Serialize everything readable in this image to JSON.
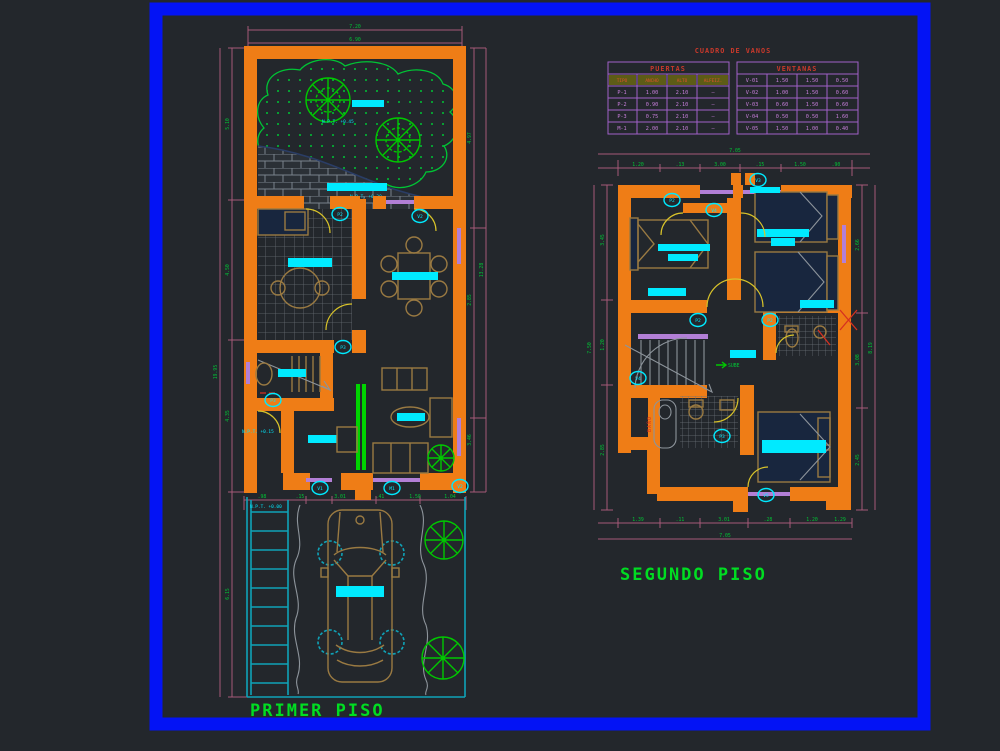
{
  "sheet": {
    "frame_color": "#0313f5",
    "background": "#23272c",
    "schedule_title": "CUADRO DE VANOS"
  },
  "floors": {
    "first": "PRIMER PISO",
    "second": "SEGUNDO PISO"
  },
  "tables": {
    "puertas": {
      "title": "PUERTAS",
      "headers": [
        "TIPO",
        "ANCHO",
        "ALTO",
        "ALFEIZ."
      ],
      "rows": [
        [
          "P-1",
          "1.00",
          "2.10",
          "—"
        ],
        [
          "P-2",
          "0.90",
          "2.10",
          "—"
        ],
        [
          "P-3",
          "0.75",
          "2.10",
          "—"
        ],
        [
          "M-1",
          "2.00",
          "2.10",
          "—"
        ]
      ]
    },
    "ventanas": {
      "title": "VENTANAS",
      "rows": [
        [
          "V-01",
          "1.50",
          "1.50",
          "0.50"
        ],
        [
          "V-02",
          "1.00",
          "1.50",
          "0.60"
        ],
        [
          "V-03",
          "0.60",
          "1.50",
          "0.60"
        ],
        [
          "V-04",
          "0.50",
          "0.50",
          "1.60"
        ],
        [
          "V-05",
          "1.50",
          "1.00",
          "0.40"
        ]
      ]
    }
  },
  "annotations": {
    "npt_garden": "N.P.T. +0.45",
    "npt_patio": "N.P.T. +0.30",
    "npt_hall": "N.P.T. +0.15",
    "npt_garage": "N.P.T. +0.00",
    "sube": "SUBE",
    "bano": "BAÑO"
  },
  "symbols": {
    "p1": "P1",
    "p2": "P2",
    "p3": "P3",
    "m1": "M1",
    "v1": "V1",
    "v2": "V2",
    "v3": "V3",
    "v4": "V4",
    "v5": "V5"
  },
  "dims": {
    "ff_top": [
      "7.20",
      "6.90"
    ],
    "ff_left": [
      "5.10",
      "4.50",
      "4.35",
      "6.15"
    ],
    "ff_left_total": "19.95",
    "ff_right": [
      "4.97",
      "2.85",
      "3.46"
    ],
    "ff_right_total": "13.28",
    "ff_bottom": [
      ".98",
      ".15",
      "3.01",
      ".41",
      "1.50",
      "1.04"
    ],
    "sf_top": [
      "1.20",
      ".13",
      "3.00",
      ".15",
      "1.50",
      ".90"
    ],
    "sf_top_total": "7.05",
    "sf_left": [
      "3.45",
      "1.20",
      "2.85"
    ],
    "sf_left_total": "7.50",
    "sf_right": [
      "2.66",
      "3.08",
      "2.45"
    ],
    "sf_right_total": "8.19",
    "sf_bottom": [
      "1.39",
      ".11",
      "3.01",
      ".28",
      "1.20",
      "1.29"
    ],
    "sf_bottom_total": "7.05"
  }
}
